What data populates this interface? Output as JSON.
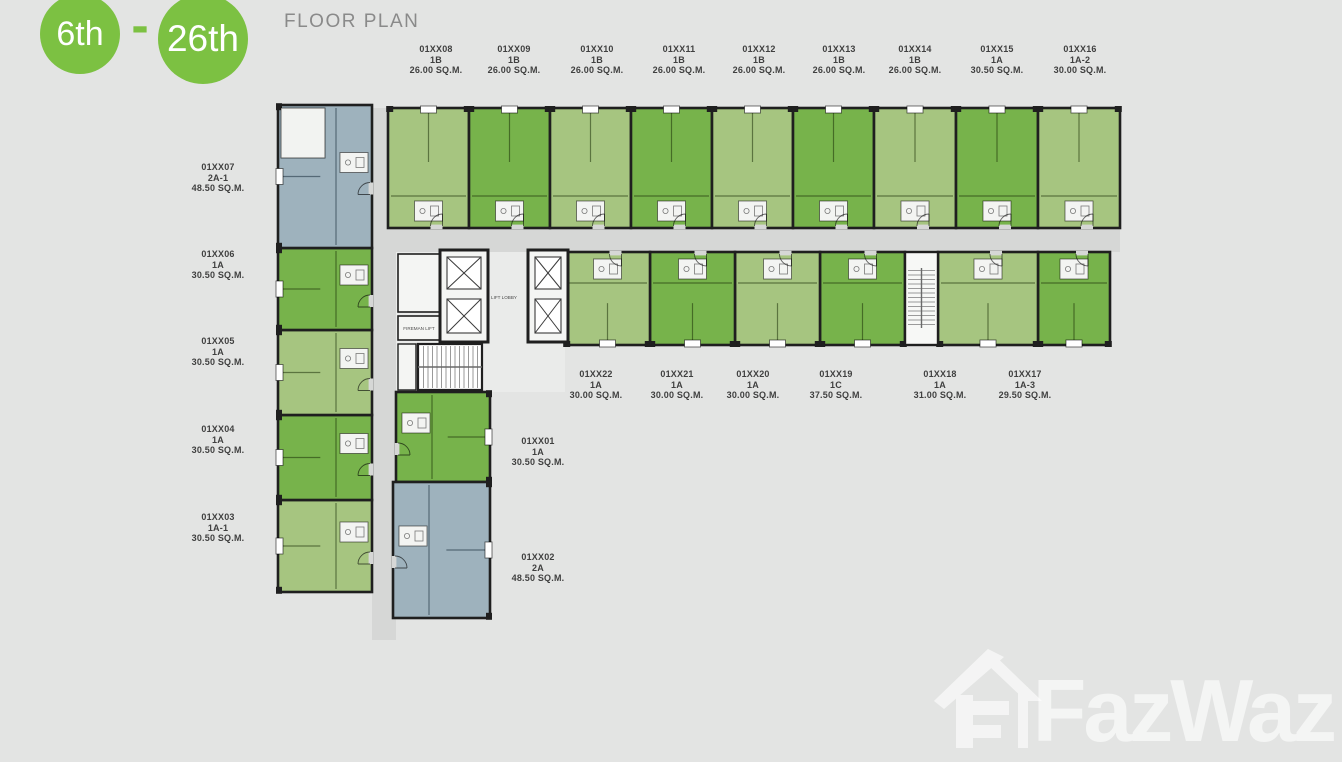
{
  "header": {
    "floor_start": "6th",
    "separator": "-",
    "floor_end": "26th",
    "title": "FLOOR PLAN"
  },
  "core": {
    "lift_lobby": "LIFT LOBBY",
    "fireman_lift": "FIREMAN LIFT"
  },
  "units": [
    {
      "id": "01XX01",
      "type": "1A",
      "area": "30.50 SQ.M.",
      "color": "mid"
    },
    {
      "id": "01XX02",
      "type": "2A",
      "area": "48.50 SQ.M.",
      "color": "blue"
    },
    {
      "id": "01XX03",
      "type": "1A-1",
      "area": "30.50 SQ.M.",
      "color": "light"
    },
    {
      "id": "01XX04",
      "type": "1A",
      "area": "30.50 SQ.M.",
      "color": "mid"
    },
    {
      "id": "01XX05",
      "type": "1A",
      "area": "30.50 SQ.M.",
      "color": "light"
    },
    {
      "id": "01XX06",
      "type": "1A",
      "area": "30.50 SQ.M.",
      "color": "mid"
    },
    {
      "id": "01XX07",
      "type": "2A-1",
      "area": "48.50 SQ.M.",
      "color": "blue"
    },
    {
      "id": "01XX08",
      "type": "1B",
      "area": "26.00 SQ.M.",
      "color": "light"
    },
    {
      "id": "01XX09",
      "type": "1B",
      "area": "26.00 SQ.M.",
      "color": "mid"
    },
    {
      "id": "01XX10",
      "type": "1B",
      "area": "26.00 SQ.M.",
      "color": "light"
    },
    {
      "id": "01XX11",
      "type": "1B",
      "area": "26.00 SQ.M.",
      "color": "mid"
    },
    {
      "id": "01XX12",
      "type": "1B",
      "area": "26.00 SQ.M.",
      "color": "light"
    },
    {
      "id": "01XX13",
      "type": "1B",
      "area": "26.00 SQ.M.",
      "color": "mid"
    },
    {
      "id": "01XX14",
      "type": "1B",
      "area": "26.00 SQ.M.",
      "color": "light"
    },
    {
      "id": "01XX15",
      "type": "1A",
      "area": "30.50 SQ.M.",
      "color": "mid"
    },
    {
      "id": "01XX16",
      "type": "1A-2",
      "area": "30.00 SQ.M.",
      "color": "light"
    },
    {
      "id": "01XX17",
      "type": "1A-3",
      "area": "29.50 SQ.M.",
      "color": "mid"
    },
    {
      "id": "01XX18",
      "type": "1A",
      "area": "31.00 SQ.M.",
      "color": "light"
    },
    {
      "id": "01XX19",
      "type": "1C",
      "area": "37.50 SQ.M.",
      "color": "mid"
    },
    {
      "id": "01XX20",
      "type": "1A",
      "area": "30.00 SQ.M.",
      "color": "light"
    },
    {
      "id": "01XX21",
      "type": "1A",
      "area": "30.00 SQ.M.",
      "color": "mid"
    },
    {
      "id": "01XX22",
      "type": "1A",
      "area": "30.00 SQ.M.",
      "color": "light"
    }
  ],
  "watermark": {
    "brand": "FazWaz"
  },
  "palette": {
    "background": "#e3e4e3",
    "badge_green": "#7cc142",
    "unit_light_green": "#a6c580",
    "unit_mid_green": "#77b34b",
    "unit_blue": "#9eb2bd",
    "wall": "#1f1f1f",
    "corridor": "#d6d7d6",
    "core_background": "#eaebea",
    "label_text": "#404040",
    "title_text": "#8a8a8a",
    "watermark": "rgba(255,255,255,0.62)"
  }
}
